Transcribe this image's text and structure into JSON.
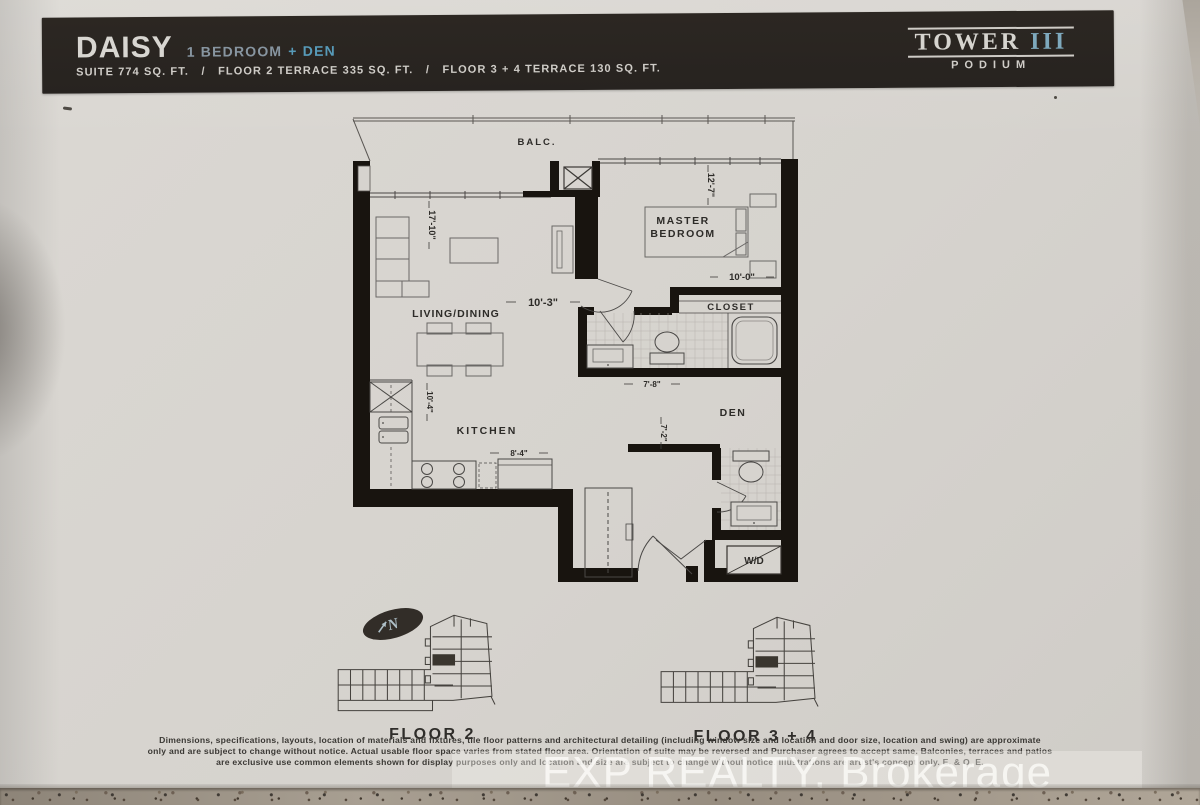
{
  "header": {
    "plan_name": "DAISY",
    "bedroom_label": "1 BEDROOM",
    "den_label": "+ DEN",
    "specs": "SUITE 774 SQ. FT.   /   FLOOR 2 TERRACE 335 SQ. FT.   /   FLOOR 3 + 4 TERRACE 130 SQ. FT.",
    "tower": {
      "name": "TOWER",
      "numeral": "III",
      "subtitle": "PODIUM"
    }
  },
  "floorplan": {
    "balcony_label": "BALC.",
    "living_label": "LIVING/DINING",
    "kitchen_label": "KITCHEN",
    "master_label_line1": "MASTER",
    "master_label_line2": "BEDROOM",
    "closet_label": "CLOSET",
    "den_label": "DEN",
    "wd_label": "W/D",
    "dims": {
      "living_width": "10'-3\"",
      "living_depth": "17'-10\"",
      "master_width": "10'-0\"",
      "master_depth": "12'-7\"",
      "kitchen_depth": "10'-4\"",
      "kitchen_width": "8'-4\"",
      "bath_width": "7'-8\"",
      "den_width": "7'-2\""
    }
  },
  "keyplans": {
    "floor2_label": "FLOOR 2",
    "floor34_label": "FLOOR 3 + 4",
    "compass_label": "N"
  },
  "footer": {
    "disclaimer_line1": "Dimensions, specifications, layouts, location of materials and fixtures, tile floor patterns and architectural detailing (including window size and location and door size, location and swing) are approximate",
    "disclaimer_line2": "only and are subject to change without notice. Actual usable floor space varies from stated floor area. Orientation of suite may be reversed and Purchaser agrees to accept same. Balconies, terraces and patios",
    "disclaimer_line3": "are exclusive use common elements shown for display purposes only and location and size are subject to change without notice. Illustrations are artist's concept only. E. & O. E.",
    "watermark": "EXP REALTY, Brokerage"
  }
}
